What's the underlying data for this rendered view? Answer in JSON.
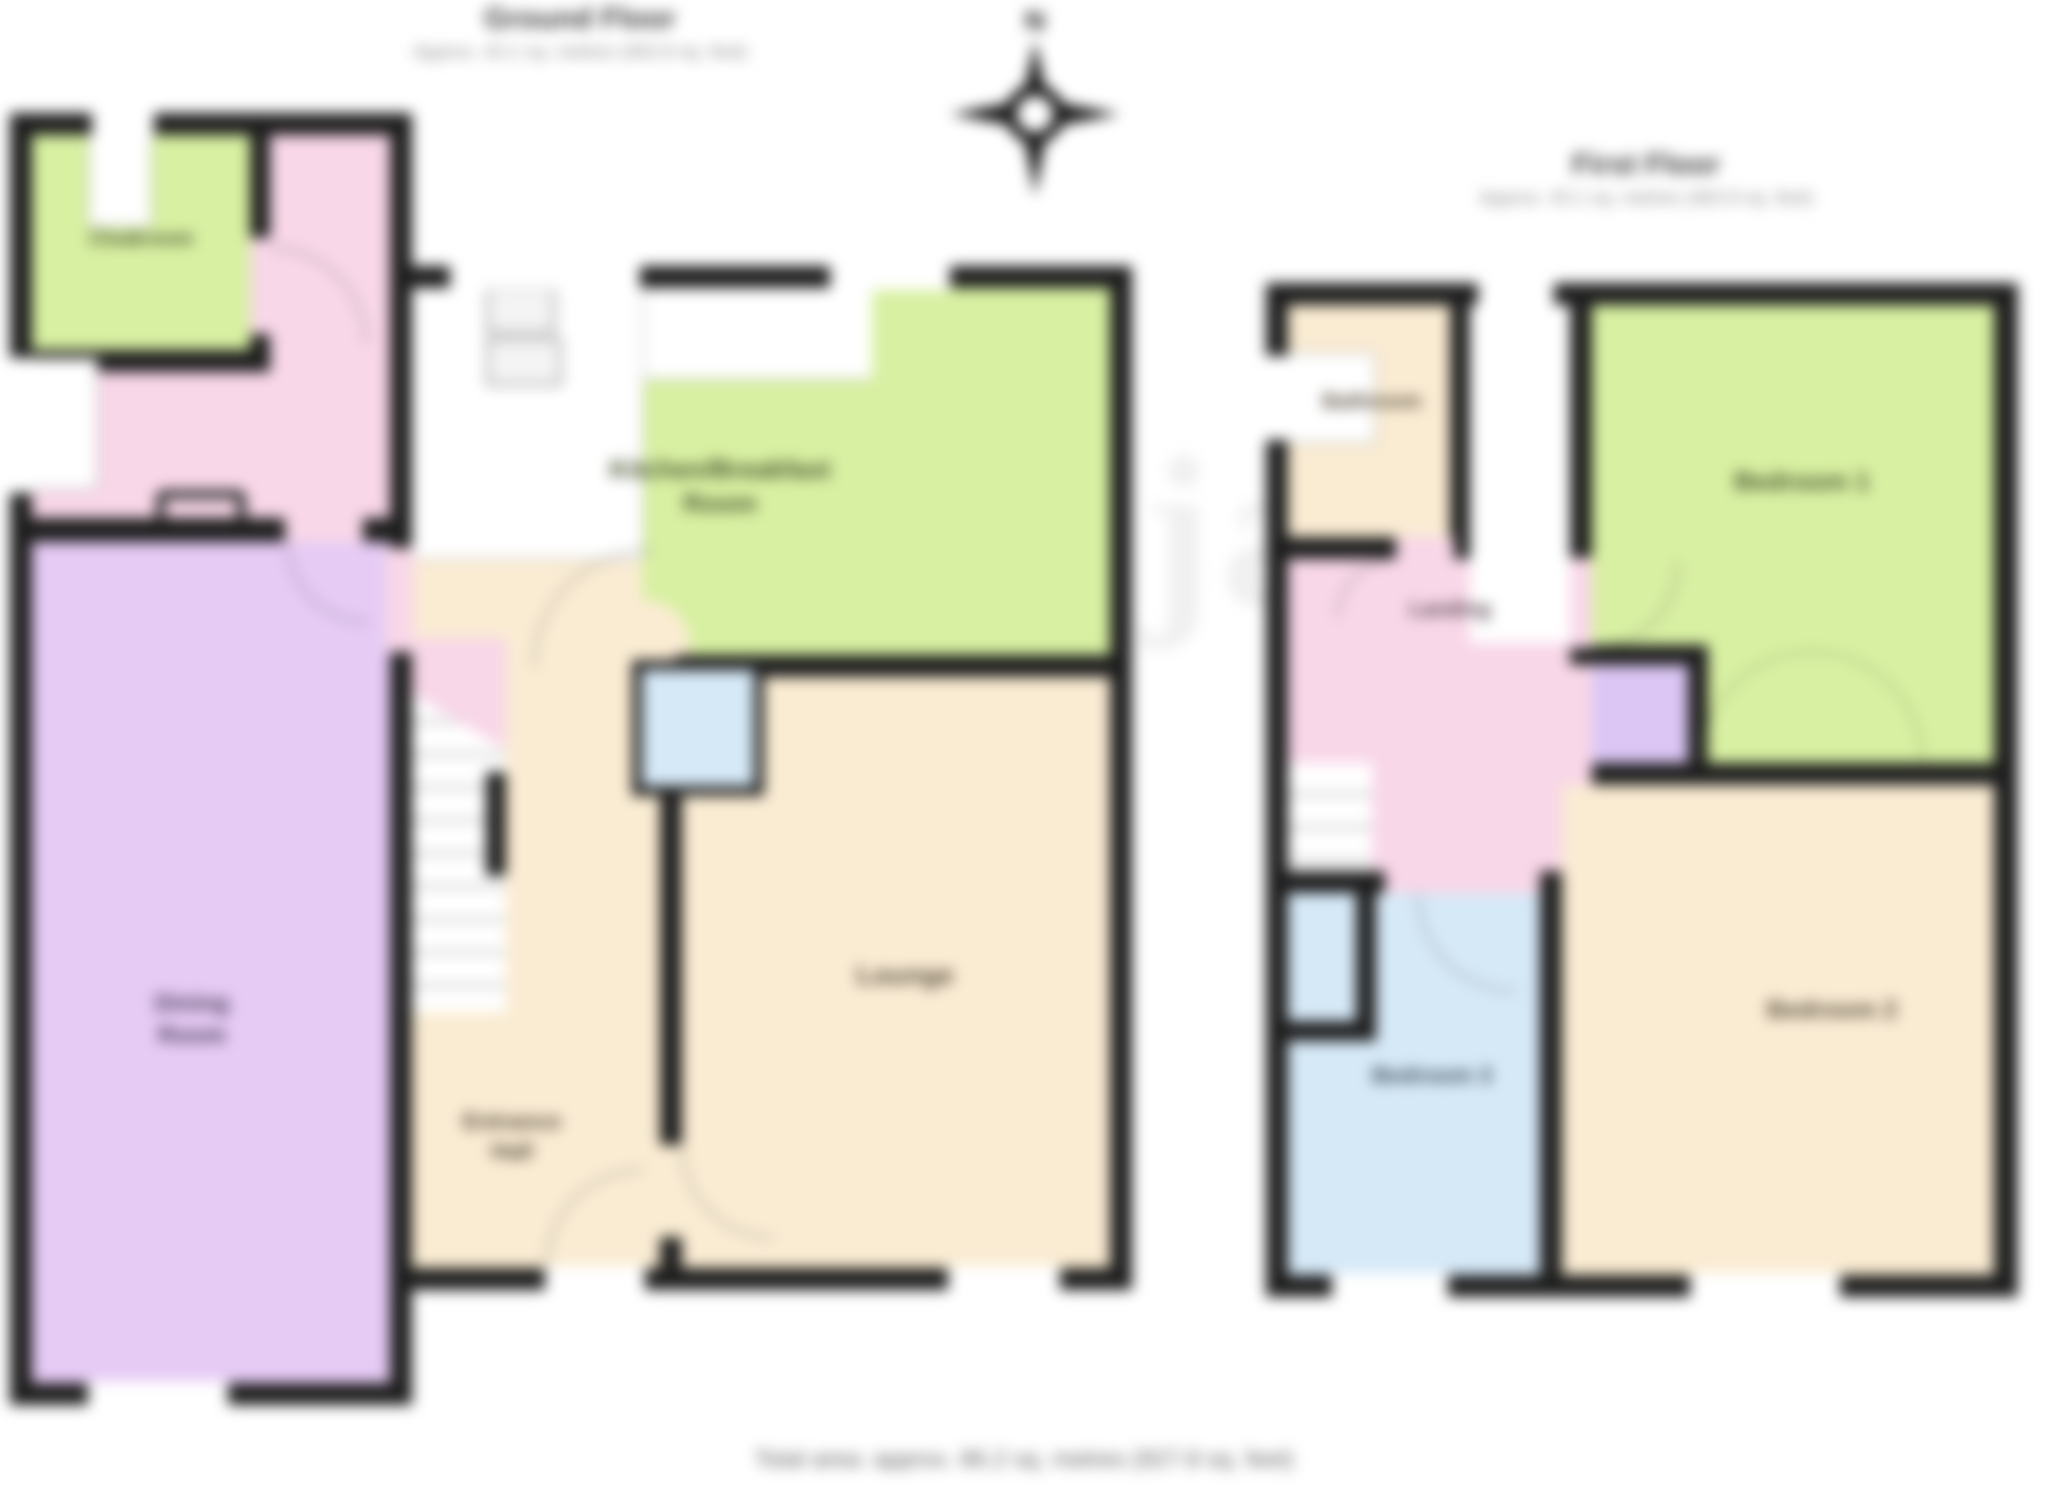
{
  "ground_floor": {
    "title": "Ground Floor",
    "subtitle": "Approx. 43.1 sq. metres (463.9 sq. feet)",
    "rooms": {
      "cloakroom": "Cloakroom",
      "kitchen_line1": "Kitchen/Breakfast",
      "kitchen_line2": "Room",
      "lounge": "Lounge",
      "hall_line1": "Entrance",
      "hall_line2": "Hall",
      "dining_line1": "Dining",
      "dining_line2": "Room"
    }
  },
  "first_floor": {
    "title": "First Floor",
    "subtitle": "Approx. 43.1 sq. metres (463.9 sq. feet)",
    "rooms": {
      "bathroom": "Bathroom",
      "bedroom1": "Bedroom 1",
      "landing": "Landing",
      "bedroom2": "Bedroom 2",
      "bedroom3": "Bedroom 3"
    }
  },
  "compass": {
    "north_label": "N"
  },
  "watermark": "richard james",
  "footer": {
    "total_area": "Total area: approx. 86.2 sq. metres (927.8 sq. feet)"
  },
  "colors": {
    "wall": "#1e1e1e",
    "floor_pink": "#f8d7e8",
    "floor_green": "#d8f0a2",
    "floor_purple": "#e6cbf5",
    "floor_cream": "#faecd3",
    "floor_blue": "#d6e9f7",
    "cupboard_purple": "#dbc6f4",
    "label_dark": "#4a4a42",
    "title_gray": "#3d3d3d",
    "subtitle_gray": "#8a8a8a",
    "watermark_gray": "#6a6a6a"
  }
}
